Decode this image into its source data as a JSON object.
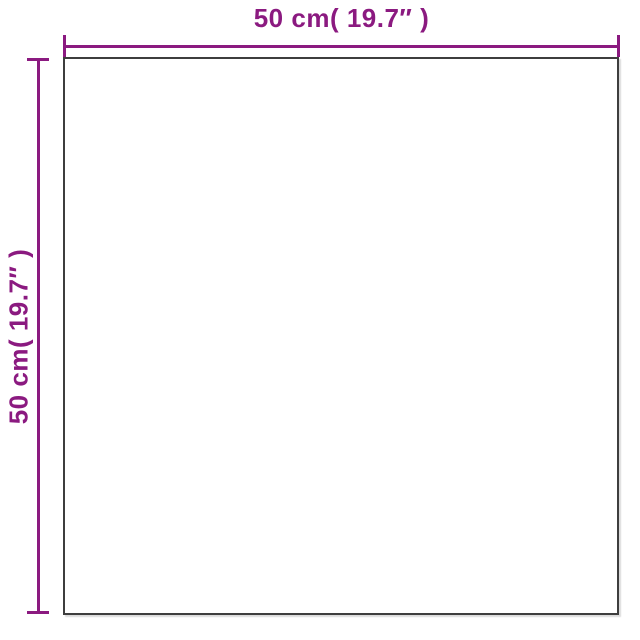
{
  "diagram": {
    "type": "product-dimension-diagram",
    "shape": "square",
    "dimensions": {
      "width_label": "50 cm( 19.7″ )",
      "height_label": "50 cm( 19.7″ )"
    },
    "colors": {
      "accent": "#8B1A80",
      "outline": "#3E3E3E",
      "background": "#FFFFFF"
    }
  }
}
